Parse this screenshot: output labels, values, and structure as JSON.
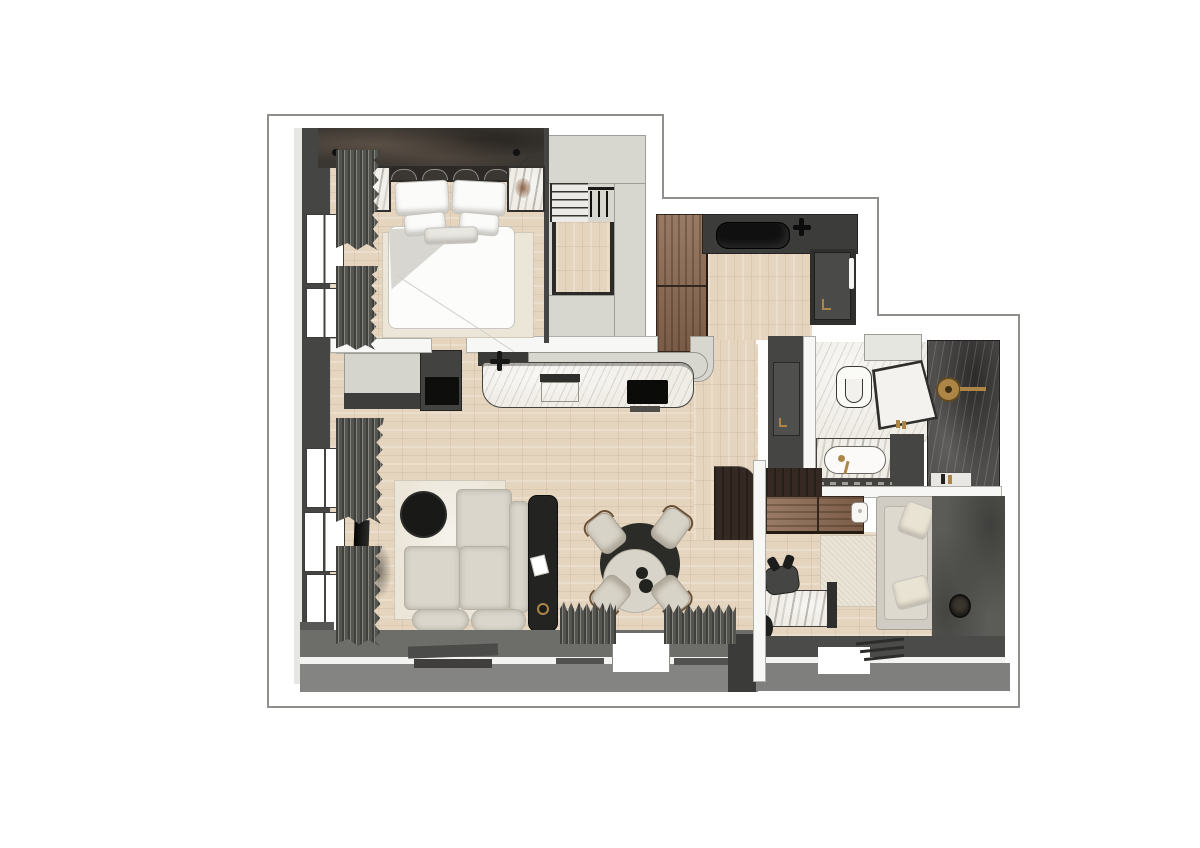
{
  "document": {
    "title": "Apartment floor plan — rendered top-down view",
    "type": "floor-plan-render",
    "visible_text": ""
  },
  "palette": {
    "bg": "#ffffff",
    "outline": "#8f8f8c",
    "wallDark": "#454543",
    "wallEdge": "#2a2a28",
    "wallLight": "#e6e6e2",
    "blockLight": "#d7d7cf",
    "bandWhite": "#f7f7f5",
    "terraceInner": "#6d6d6a",
    "terraceOuter": "#848482",
    "studyBandInner": "#4b4b49",
    "studyBandOuter": "#7f7f7d",
    "wood": "#e5d5bf",
    "cabinetWood": "#8a6850",
    "espresso": "#342a23",
    "marble": "#f0ede7",
    "marbleDark": "#504e4d",
    "cream": "#dad6cc",
    "rug": "#ece6d9",
    "rugStudy": "#eae4d6",
    "black": "#131311",
    "charcoal": "#232321",
    "gold": "#ad8647",
    "glass": "#f3f2ee",
    "feature": "#3a3631",
    "duvetShade": "#d8d6d1"
  },
  "rooms": [
    {
      "id": "bedroom",
      "label": "bedroom",
      "furniture": [
        "double-bed",
        "headboard",
        "pillows",
        "duvet",
        "area-rug",
        "nightstand-left",
        "nightstand-right",
        "pendant-lamp-left",
        "pendant-lamp-right",
        "feature-wall",
        "windows",
        "curtains"
      ]
    },
    {
      "id": "staircase",
      "label": "staircase",
      "furniture": [
        "upper-landing",
        "stair-treads",
        "railing-balusters",
        "stair-well-wood"
      ]
    },
    {
      "id": "kitchen",
      "label": "kitchen",
      "furniture": [
        "tall-wood-cabinet",
        "dark-worktop",
        "kitchen-sink",
        "faucet",
        "fridge-tall-unit",
        "door-handle"
      ]
    },
    {
      "id": "kitchen-island",
      "label": "kitchen island",
      "furniture": [
        "marble-counter",
        "induction-cooktop",
        "island-sink",
        "island-faucet",
        "bar-counter",
        "side-appliance"
      ]
    },
    {
      "id": "living-room",
      "label": "living room",
      "furniture": [
        "sectional-sofa",
        "round-coffee-table",
        "tv-panel",
        "media-console",
        "area-rug",
        "round-dining-table",
        "dining-chairs",
        "curtains"
      ]
    },
    {
      "id": "bathroom",
      "label": "bathroom",
      "furniture": [
        "toilet",
        "walk-in-shower",
        "glass-shower-door",
        "rain-shower-head",
        "vanity-counter",
        "basin",
        "gold-faucet",
        "bathroom-door",
        "shelf"
      ]
    },
    {
      "id": "study",
      "label": "study / second room",
      "furniture": [
        "marble-desk",
        "office-chair",
        "wall-cabinets",
        "daybed",
        "cushions",
        "area-rug",
        "round-floor-object",
        "plant"
      ]
    },
    {
      "id": "terrace",
      "label": "terrace band",
      "furniture": [
        "doormats",
        "threshold-opening"
      ]
    }
  ],
  "counts": {
    "dining_chairs": 4,
    "stair_balusters": 3,
    "bed_pillows": 5,
    "doormats": 4,
    "living_windows": 3,
    "bedroom_windows": 2
  }
}
